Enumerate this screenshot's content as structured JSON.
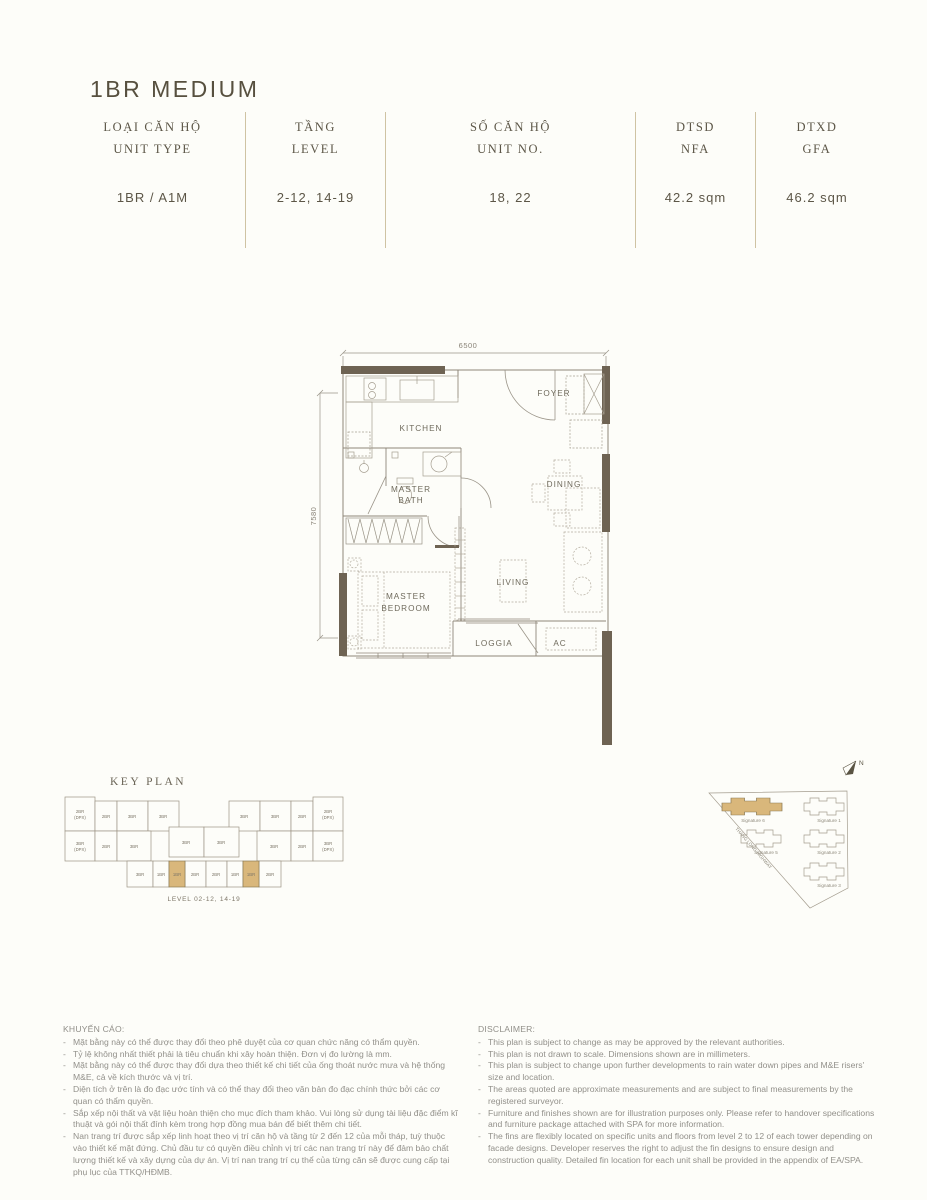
{
  "header": {
    "title": "1BR MEDIUM",
    "columns": [
      {
        "label_vi": "LOẠI CĂN HỘ",
        "label_en": "UNIT TYPE",
        "value": "1BR / A1M"
      },
      {
        "label_vi": "TẦNG",
        "label_en": "LEVEL",
        "value": "2-12, 14-19"
      },
      {
        "label_vi": "SỐ CĂN HỘ",
        "label_en": "UNIT NO.",
        "value": "18, 22"
      },
      {
        "label_vi": "DTSD",
        "label_en": "NFA",
        "value": "42.2 sqm"
      },
      {
        "label_vi": "DTXD",
        "label_en": "GFA",
        "value": "46.2 sqm"
      }
    ]
  },
  "floorplan": {
    "dim_width": "6500",
    "dim_height": "7580",
    "rooms": {
      "kitchen": "KITCHEN",
      "foyer": "FOYER",
      "master_bath_1": "MASTER",
      "master_bath_2": "BATH",
      "dining": "DINING",
      "master_bedroom_1": "MASTER",
      "master_bedroom_2": "BEDROOM",
      "living": "LIVING",
      "loggia": "LOGGIA",
      "ac": "AC"
    }
  },
  "keyplan": {
    "title": "KEY PLAN",
    "level_label": "LEVEL 02-12, 14-19",
    "rows": [
      {
        "units": [
          {
            "l": "2BR",
            "s": "(DPX)"
          },
          {
            "l": "2BR"
          },
          {
            "l": "3BR"
          },
          {
            "l": "3BR"
          },
          {
            "l": "3BR"
          },
          {
            "l": "3BR"
          },
          {
            "l": "2BR"
          },
          {
            "l": "2BR",
            "s": "(DPX)"
          }
        ]
      },
      {
        "units": [
          {
            "l": "3BR",
            "s": "(DPX)"
          },
          {
            "l": "2BR"
          },
          {
            "l": "3BR"
          },
          {
            "l": "3BR"
          },
          {
            "l": "3BR"
          },
          {
            "l": "3BR"
          },
          {
            "l": "2BR"
          },
          {
            "l": "3BR",
            "s": "(DPX)"
          }
        ]
      },
      {
        "units": [
          {
            "l": "3BR"
          },
          {
            "l": "1BR"
          },
          {
            "l": "1BR"
          },
          {
            "l": "2BR"
          },
          {
            "l": "2BR"
          },
          {
            "l": "1BR"
          },
          {
            "l": "1BR"
          },
          {
            "l": "2BR"
          }
        ]
      }
    ],
    "highlighted_indexes": [
      2,
      6
    ]
  },
  "siteplan": {
    "north_label": "N",
    "road_label": "THANG LONG HIGHWAY",
    "buildings": [
      {
        "name": "Signature 6",
        "highlighted": true
      },
      {
        "name": "Signature 1",
        "highlighted": false
      },
      {
        "name": "Signature 5",
        "highlighted": false
      },
      {
        "name": "Signature 2",
        "highlighted": false
      },
      {
        "name": "Signature 3",
        "highlighted": false
      }
    ]
  },
  "notes_vi": {
    "title": "KHUYẾN CÁO:",
    "items": [
      "Mặt bằng này có thể được thay đổi theo phê duyệt của cơ quan chức năng có thẩm quyền.",
      "Tỷ lệ không nhất thiết phải là tiêu chuẩn khi xây hoàn thiện. Đơn vị đo lường là mm.",
      "Mặt bằng này có thể được thay đổi dựa theo thiết kế chi tiết của ống thoát nước mưa và hệ thống M&E, cả về kích thước và vị trí.",
      "Diện tích ở trên là đo đạc ước tính và có thể thay đổi theo văn bản đo đạc chính thức bởi các cơ quan có thẩm quyền.",
      "Sắp xếp nội thất và vật liệu hoàn thiện cho mục đích tham khảo. Vui lòng sử dụng tài liệu đặc điểm kĩ thuật và gói nội thất đính kèm trong hợp đồng mua bán để biết thêm chi tiết.",
      "Nan trang trí được sắp xếp linh hoạt theo vị trí căn hộ và tầng từ 2 đến 12 của mỗi tháp, tuỳ thuộc vào thiết kế mặt đứng. Chủ đầu tư có quyền điều chỉnh vị trí các nan trang trí này để đảm bảo chất lượng thiết kế và xây dựng của dự án. Vị trí nan trang trí cụ thể của từng căn sẽ được cung cấp tại phụ lục của TTKQ/HĐMB."
    ]
  },
  "disclaimer_en": {
    "title": "DISCLAIMER:",
    "items": [
      "This plan is subject to change as may be approved by the relevant authorities.",
      "This plan is not drawn to scale. Dimensions shown are in millimeters.",
      "This plan is subject to change upon further developments to rain water down pipes and M&E risers' size and location.",
      "The areas quoted are approximate measurements and are subject to final measurements by the registered surveyor.",
      "Furniture and finishes shown are for illustration purposes only. Please refer to handover specifications and furniture package attached with SPA for more information.",
      "The fins are flexibly located on specific units and floors from level 2 to 12 of each tower depending on facade designs. Developer reserves the right to adjust the fin designs to ensure design and construction quality. Detailed fin location for each unit shall be provided in the appendix of EA/SPA."
    ]
  },
  "colors": {
    "wall_accent": "#6e6353",
    "highlight_tan": "#d9b77b",
    "rule_tan": "#cfc3a3",
    "text_dark": "#5a5444",
    "text_muted": "#92908a"
  }
}
